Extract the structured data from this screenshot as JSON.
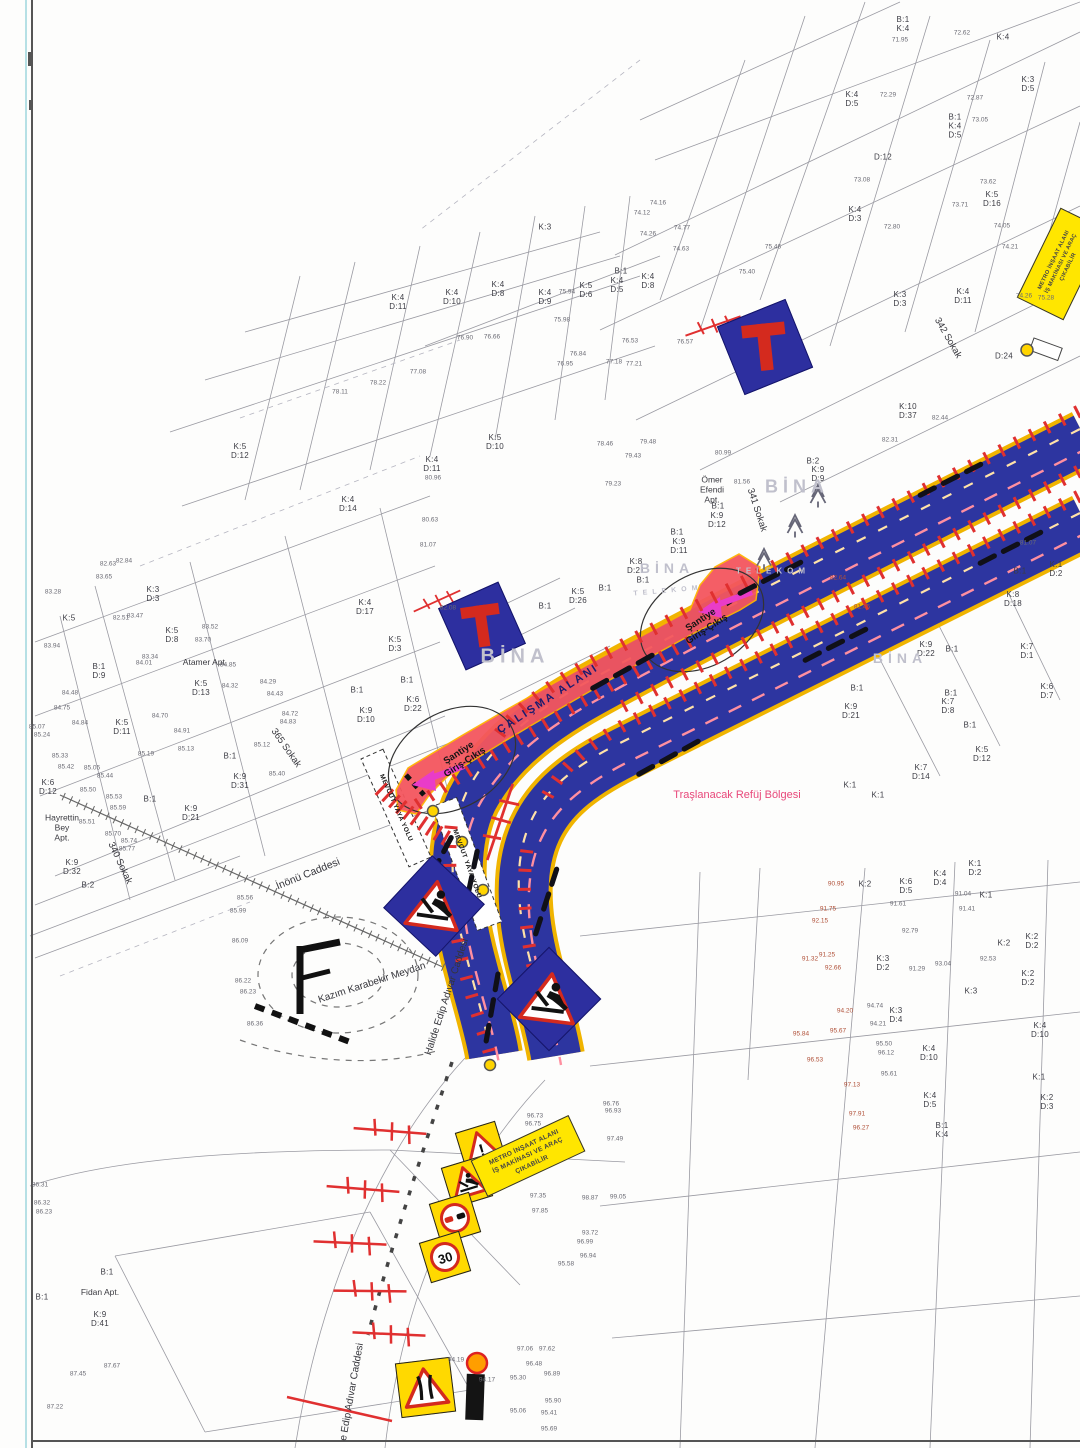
{
  "colors": {
    "road_blue": "#2d35a0",
    "road_edge_yellow": "#f0b400",
    "lane_pink": "#ff8fa0",
    "lane_cream": "#ffe2a8",
    "work_red": "#f4565e",
    "barrier_red": "#e03030",
    "magenta": "#e93cc8",
    "sign_blue": "#2d2f9f",
    "sign_red": "#d42a1e",
    "sign_yellow": "#ffd900",
    "panel_yellow": "#ffe600",
    "pink_text": "#e8487a",
    "navy_text": "#1b1b6e"
  },
  "map": {
    "signs": {
      "speed_limit": "30",
      "warning_mark": "!",
      "metro_panel_lines": [
        "METRO İNŞAAT ALANI",
        "İŞ MAKİNASI VE ARAÇ",
        "ÇIKABİLİR"
      ]
    },
    "texts": [
      {
        "n": "street-inonu-caddesi",
        "t": "İnönü Caddesi",
        "x": 308,
        "y": 874,
        "r": -22,
        "s": 10.5,
        "c": "street"
      },
      {
        "n": "street-kazim-karabekir-meydan",
        "t": "Kazım Karabekir Meydan",
        "x": 372,
        "y": 983,
        "r": -18,
        "s": 10,
        "c": "street"
      },
      {
        "n": "street-halide-edip-adivar-1",
        "t": "Halide Edip Adıvar Caddesi",
        "x": 447,
        "y": 997,
        "r": -72,
        "s": 10,
        "c": "street"
      },
      {
        "n": "street-halide-edip-adivar-2",
        "t": "e Edip Adıvar Caddesi",
        "x": 352,
        "y": 1392,
        "r": -80,
        "s": 10,
        "c": "street"
      },
      {
        "n": "street-365-sokak",
        "t": "365 Sokak",
        "x": 286,
        "y": 748,
        "r": 55,
        "s": 9.5,
        "c": "street"
      },
      {
        "n": "street-340-sokak",
        "t": "340 Sokak",
        "x": 120,
        "y": 863,
        "r": 65,
        "s": 9.5,
        "c": "street"
      },
      {
        "n": "street-341-sokak",
        "t": "341 Sokak",
        "x": 757,
        "y": 510,
        "r": 72,
        "s": 9.5,
        "c": "street"
      },
      {
        "n": "street-342-sokak",
        "t": "342 Sokak",
        "x": 948,
        "y": 338,
        "r": 60,
        "s": 9.5,
        "c": "street"
      },
      {
        "n": "note-median-shaving",
        "t": "Traşlanacak Refüj Bölgesi",
        "x": 737,
        "y": 795,
        "r": 0,
        "s": 11,
        "c": "pink"
      },
      {
        "n": "label-work-area",
        "t": "ÇALIŞMA ALANI",
        "x": 548,
        "y": 699,
        "r": -33,
        "s": 11,
        "c": "workt"
      },
      {
        "n": "label-site-access-west",
        "t": "Şantiye\nGiriş-Çıkış",
        "x": 462,
        "y": 758,
        "r": -33,
        "s": 9.5,
        "c": "sant"
      },
      {
        "n": "label-site-access-east",
        "t": "Şantiye\nGiriş-Çıkış",
        "x": 704,
        "y": 625,
        "r": -33,
        "s": 9.5,
        "c": "sant"
      },
      {
        "n": "label-ped-path-1",
        "t": "MEVCUT YAYA YOLU",
        "x": 396,
        "y": 808,
        "r": 66,
        "s": 6.5,
        "c": "ped"
      },
      {
        "n": "label-ped-path-2",
        "t": "MEVCUT YAYA YOLU",
        "x": 467,
        "y": 864,
        "r": 70,
        "s": 6.5,
        "c": "ped"
      },
      {
        "n": "apt-atamer",
        "t": "Atamer Apt.",
        "x": 205,
        "y": 662,
        "r": 0,
        "s": 8.5,
        "c": "apt"
      },
      {
        "n": "apt-hayrettin-bey",
        "t": "Hayrettin\nBey\nApt.",
        "x": 62,
        "y": 828,
        "r": 0,
        "s": 8.5,
        "c": "apt"
      },
      {
        "n": "apt-omer-efendi",
        "t": "Ömer\nEfendi\nApt.",
        "x": 712,
        "y": 490,
        "r": 0,
        "s": 8.5,
        "c": "apt"
      },
      {
        "n": "apt-fidan",
        "t": "Fidan Apt.",
        "x": 100,
        "y": 1292,
        "r": 0,
        "s": 8.5,
        "c": "apt"
      },
      {
        "n": "watermark-bina-1",
        "t": "BİNA",
        "x": 515,
        "y": 657,
        "r": 0,
        "s": 20,
        "c": "bina"
      },
      {
        "n": "watermark-bina-2",
        "t": "BİNA",
        "x": 797,
        "y": 487,
        "r": 0,
        "s": 18,
        "c": "bina"
      },
      {
        "n": "watermark-bina-3",
        "t": "BİNA",
        "x": 667,
        "y": 568,
        "r": 0,
        "s": 14,
        "c": "bina"
      },
      {
        "n": "watermark-bina-4",
        "t": "BİNA",
        "x": 900,
        "y": 658,
        "r": 0,
        "s": 14,
        "c": "bina"
      },
      {
        "n": "watermark-telekom-1",
        "t": "TELEKOM",
        "x": 773,
        "y": 571,
        "r": 0,
        "s": 8,
        "c": "bina"
      },
      {
        "n": "watermark-telekom-2",
        "t": "TELEKOM",
        "x": 668,
        "y": 591,
        "r": -5,
        "s": 7,
        "c": "bina"
      }
    ],
    "parcels": [
      [
        398,
        303,
        "K:4\nD:11"
      ],
      [
        452,
        298,
        "K:4\nD:10"
      ],
      [
        498,
        290,
        "K:4\nD:8"
      ],
      [
        545,
        298,
        "K:4\nD:9"
      ],
      [
        586,
        291,
        "K:5\nD:6"
      ],
      [
        617,
        286,
        "K:4\nD:5"
      ],
      [
        621,
        272,
        "B:1"
      ],
      [
        648,
        282,
        "K:4\nD:8"
      ],
      [
        545,
        228,
        "K:3"
      ],
      [
        495,
        443,
        "K:5\nD:10"
      ],
      [
        432,
        465,
        "K:4\nD:11"
      ],
      [
        348,
        505,
        "K:4\nD:14"
      ],
      [
        240,
        452,
        "K:5\nD:12"
      ],
      [
        69,
        619,
        "K:5"
      ],
      [
        153,
        595,
        "K:3\nD:3"
      ],
      [
        172,
        636,
        "K:5\nD:8"
      ],
      [
        99,
        672,
        "B:1\nD:9"
      ],
      [
        201,
        689,
        "K:5\nD:13"
      ],
      [
        122,
        728,
        "K:5\nD:11"
      ],
      [
        48,
        788,
        "K:6\nD:12"
      ],
      [
        230,
        757,
        "B:1"
      ],
      [
        240,
        782,
        "K:9\nD:31"
      ],
      [
        191,
        814,
        "K:9\nD:21"
      ],
      [
        150,
        800,
        "B:1"
      ],
      [
        72,
        868,
        "K:9\nD:32"
      ],
      [
        88,
        886,
        "B:2"
      ],
      [
        365,
        608,
        "K:4\nD:17"
      ],
      [
        395,
        645,
        "K:5\nD:3"
      ],
      [
        407,
        681,
        "B:1"
      ],
      [
        357,
        691,
        "B:1"
      ],
      [
        366,
        716,
        "K:9\nD:10"
      ],
      [
        413,
        705,
        "K:6\nD:22"
      ],
      [
        545,
        607,
        "B:1"
      ],
      [
        578,
        597,
        "K:5\nD:26"
      ],
      [
        605,
        589,
        "B:1"
      ],
      [
        636,
        567,
        "K:8\nD:21"
      ],
      [
        643,
        581,
        "B:1"
      ],
      [
        677,
        533,
        "B:1"
      ],
      [
        679,
        547,
        "K:9\nD:11"
      ],
      [
        718,
        507,
        "B:1"
      ],
      [
        717,
        521,
        "K:9\nD:12"
      ],
      [
        813,
        462,
        "B:2"
      ],
      [
        818,
        475,
        "K:9\nD:9"
      ],
      [
        855,
        215,
        "K:4\nD:3"
      ],
      [
        900,
        300,
        "K:3\nD:3"
      ],
      [
        903,
        25,
        "B:1\nK:4"
      ],
      [
        1003,
        38,
        "K:4"
      ],
      [
        852,
        100,
        "K:4\nD:5"
      ],
      [
        1028,
        85,
        "K:3\nD:5"
      ],
      [
        955,
        127,
        "B:1\nK:4\nD:5"
      ],
      [
        883,
        158,
        "D:12"
      ],
      [
        992,
        200,
        "K:5\nD:16"
      ],
      [
        963,
        297,
        "K:4\nD:11"
      ],
      [
        1004,
        357,
        "D:24"
      ],
      [
        908,
        412,
        "K:10\nD:37"
      ],
      [
        1020,
        572,
        "B:1"
      ],
      [
        1056,
        570,
        "K:1\nD:2"
      ],
      [
        1013,
        600,
        "K:8\nD:18"
      ],
      [
        1027,
        652,
        "K:7\nD:1"
      ],
      [
        1047,
        692,
        "K:6\nD:7"
      ],
      [
        926,
        650,
        "K:9\nD:22"
      ],
      [
        952,
        650,
        "B:1"
      ],
      [
        951,
        694,
        "B:1"
      ],
      [
        948,
        707,
        "K:7\nD:8"
      ],
      [
        970,
        726,
        "B:1"
      ],
      [
        982,
        755,
        "K:5\nD:12"
      ],
      [
        857,
        689,
        "B:1"
      ],
      [
        851,
        712,
        "K:9\nD:21"
      ],
      [
        921,
        773,
        "K:7\nD:14"
      ],
      [
        850,
        786,
        "K:1"
      ],
      [
        878,
        796,
        "K:1"
      ],
      [
        865,
        885,
        "K:2"
      ],
      [
        906,
        887,
        "K:6\nD:5"
      ],
      [
        940,
        879,
        "K:4\nD:4"
      ],
      [
        975,
        869,
        "K:1\nD:2"
      ],
      [
        986,
        896,
        "K:1"
      ],
      [
        1032,
        942,
        "K:2\nD:2"
      ],
      [
        1004,
        944,
        "K:2"
      ],
      [
        1028,
        979,
        "K:2\nD:2"
      ],
      [
        883,
        964,
        "K:3\nD:2"
      ],
      [
        971,
        992,
        "K:3"
      ],
      [
        896,
        1016,
        "K:3\nD:4"
      ],
      [
        1040,
        1031,
        "K:4\nD:10"
      ],
      [
        929,
        1054,
        "K:4\nD:10"
      ],
      [
        930,
        1101,
        "K:4\nD:5"
      ],
      [
        942,
        1131,
        "B:1\nK:4"
      ],
      [
        1039,
        1078,
        "K:1"
      ],
      [
        1047,
        1103,
        "K:2\nD:3"
      ],
      [
        107,
        1273,
        "B:1"
      ],
      [
        100,
        1320,
        "K:9\nD:41"
      ],
      [
        42,
        1298,
        "B:1"
      ]
    ],
    "elevations": [
      [
        900,
        40,
        "71.95"
      ],
      [
        962,
        33,
        "72.62"
      ],
      [
        888,
        95,
        "72.29"
      ],
      [
        975,
        98,
        "72.87"
      ],
      [
        980,
        120,
        "73.05"
      ],
      [
        862,
        180,
        "73.08"
      ],
      [
        988,
        182,
        "73.62"
      ],
      [
        960,
        205,
        "73.71"
      ],
      [
        892,
        227,
        "72.80"
      ],
      [
        1002,
        226,
        "74.05"
      ],
      [
        1010,
        247,
        "74.21"
      ],
      [
        1024,
        296,
        "74.26"
      ],
      [
        1046,
        298,
        "75.28"
      ],
      [
        658,
        203,
        "74.16"
      ],
      [
        642,
        213,
        "74.12"
      ],
      [
        648,
        234,
        "74.26"
      ],
      [
        682,
        228,
        "74.77"
      ],
      [
        681,
        249,
        "74.63"
      ],
      [
        747,
        272,
        "75.40"
      ],
      [
        773,
        247,
        "75.46"
      ],
      [
        630,
        341,
        "76.53"
      ],
      [
        685,
        342,
        "76.57"
      ],
      [
        578,
        354,
        "76.84"
      ],
      [
        614,
        362,
        "77.18"
      ],
      [
        634,
        364,
        "77.21"
      ],
      [
        565,
        364,
        "76.95"
      ],
      [
        562,
        320,
        "75.98"
      ],
      [
        567,
        292,
        "75.94"
      ],
      [
        605,
        444,
        "78.46"
      ],
      [
        648,
        442,
        "79.48"
      ],
      [
        633,
        456,
        "79.43"
      ],
      [
        723,
        453,
        "80.99"
      ],
      [
        742,
        482,
        "81.56"
      ],
      [
        613,
        484,
        "79.23"
      ],
      [
        465,
        338,
        "76.90"
      ],
      [
        492,
        337,
        "76.66"
      ],
      [
        418,
        372,
        "77.08"
      ],
      [
        378,
        383,
        "78.22"
      ],
      [
        340,
        392,
        "78.11"
      ],
      [
        433,
        478,
        "80.96"
      ],
      [
        430,
        520,
        "80.63"
      ],
      [
        428,
        545,
        "81.07"
      ],
      [
        448,
        608,
        "82.08"
      ],
      [
        108,
        564,
        "82.63"
      ],
      [
        124,
        561,
        "82.84"
      ],
      [
        104,
        577,
        "83.65"
      ],
      [
        53,
        592,
        "83.28"
      ],
      [
        135,
        616,
        "83.47"
      ],
      [
        121,
        618,
        "82.51"
      ],
      [
        210,
        627,
        "83.52"
      ],
      [
        203,
        640,
        "83.70"
      ],
      [
        52,
        646,
        "83.94"
      ],
      [
        150,
        657,
        "83.34"
      ],
      [
        144,
        663,
        "84.01"
      ],
      [
        228,
        665,
        "84.85"
      ],
      [
        230,
        686,
        "84.32"
      ],
      [
        268,
        682,
        "84.29"
      ],
      [
        275,
        694,
        "84.43"
      ],
      [
        290,
        714,
        "84.72"
      ],
      [
        288,
        722,
        "84.83"
      ],
      [
        70,
        693,
        "84.48"
      ],
      [
        62,
        708,
        "84.75"
      ],
      [
        80,
        723,
        "84.84"
      ],
      [
        160,
        716,
        "84.70"
      ],
      [
        182,
        731,
        "84.91"
      ],
      [
        186,
        749,
        "85.13"
      ],
      [
        262,
        745,
        "85.12"
      ],
      [
        37,
        727,
        "85.07"
      ],
      [
        42,
        735,
        "85.24"
      ],
      [
        60,
        756,
        "85.33"
      ],
      [
        66,
        767,
        "85.42"
      ],
      [
        105,
        776,
        "85.44"
      ],
      [
        92,
        768,
        "85.05"
      ],
      [
        146,
        754,
        "85.19"
      ],
      [
        277,
        774,
        "85.40"
      ],
      [
        88,
        790,
        "85.50"
      ],
      [
        114,
        797,
        "85.53"
      ],
      [
        118,
        808,
        "85.59"
      ],
      [
        87,
        822,
        "85.51"
      ],
      [
        113,
        834,
        "85.70"
      ],
      [
        129,
        841,
        "85.74"
      ],
      [
        127,
        849,
        "85.77"
      ],
      [
        245,
        898,
        "85.56"
      ],
      [
        238,
        911,
        "85.99"
      ],
      [
        240,
        941,
        "86.09"
      ],
      [
        243,
        981,
        "86.22"
      ],
      [
        248,
        992,
        "86.23"
      ],
      [
        255,
        1024,
        "86.36"
      ],
      [
        40,
        1185,
        "86.31"
      ],
      [
        42,
        1203,
        "86.32"
      ],
      [
        44,
        1212,
        "86.23"
      ],
      [
        78,
        1374,
        "87.45"
      ],
      [
        112,
        1366,
        "87.67"
      ],
      [
        55,
        1407,
        "87.22"
      ],
      [
        535,
        1116,
        "96.73"
      ],
      [
        533,
        1124,
        "96.75"
      ],
      [
        611,
        1104,
        "96.76"
      ],
      [
        613,
        1111,
        "96.93"
      ],
      [
        615,
        1139,
        "97.49"
      ],
      [
        538,
        1196,
        "97.35"
      ],
      [
        590,
        1198,
        "98.87"
      ],
      [
        618,
        1197,
        "99.05"
      ],
      [
        540,
        1211,
        "97.85"
      ],
      [
        590,
        1233,
        "93.72"
      ],
      [
        585,
        1242,
        "96.99"
      ],
      [
        588,
        1256,
        "96.94"
      ],
      [
        566,
        1264,
        "95.58"
      ],
      [
        456,
        1360,
        "94.19"
      ],
      [
        487,
        1380,
        "94.17"
      ],
      [
        525,
        1349,
        "97.06"
      ],
      [
        547,
        1349,
        "97.62"
      ],
      [
        534,
        1364,
        "96.48"
      ],
      [
        518,
        1378,
        "95.30"
      ],
      [
        552,
        1374,
        "96.89"
      ],
      [
        553,
        1401,
        "95.90"
      ],
      [
        549,
        1413,
        "95.41"
      ],
      [
        518,
        1411,
        "95.06"
      ],
      [
        549,
        1429,
        "95.69"
      ],
      [
        967,
        909,
        "91.41"
      ],
      [
        963,
        894,
        "91.04"
      ],
      [
        898,
        904,
        "91.61"
      ],
      [
        910,
        931,
        "92.79"
      ],
      [
        943,
        964,
        "93.04"
      ],
      [
        917,
        969,
        "91.29"
      ],
      [
        988,
        959,
        "92.53"
      ],
      [
        875,
        1006,
        "94.74"
      ],
      [
        878,
        1024,
        "94.21"
      ],
      [
        884,
        1044,
        "95.50"
      ],
      [
        886,
        1053,
        "96.12"
      ],
      [
        889,
        1074,
        "95.61"
      ],
      [
        940,
        418,
        "82.44"
      ],
      [
        890,
        440,
        "82.31"
      ],
      [
        1028,
        543,
        "81.07"
      ],
      [
        836,
        884,
        "90.95",
        "r"
      ],
      [
        828,
        909,
        "91.75",
        "r"
      ],
      [
        820,
        921,
        "92.15",
        "r"
      ],
      [
        827,
        955,
        "91.25",
        "r"
      ],
      [
        810,
        959,
        "91.32",
        "r"
      ],
      [
        833,
        968,
        "92.66",
        "r"
      ],
      [
        845,
        1011,
        "94.20",
        "r"
      ],
      [
        838,
        1031,
        "95.67",
        "r"
      ],
      [
        801,
        1034,
        "95.84",
        "r"
      ],
      [
        815,
        1060,
        "96.53",
        "r"
      ],
      [
        852,
        1085,
        "97.13",
        "r"
      ],
      [
        857,
        1114,
        "97.91",
        "r"
      ],
      [
        861,
        1128,
        "96.27",
        "r"
      ],
      [
        838,
        578,
        "82.64",
        "r"
      ],
      [
        862,
        607,
        "81.45",
        "r"
      ]
    ]
  }
}
